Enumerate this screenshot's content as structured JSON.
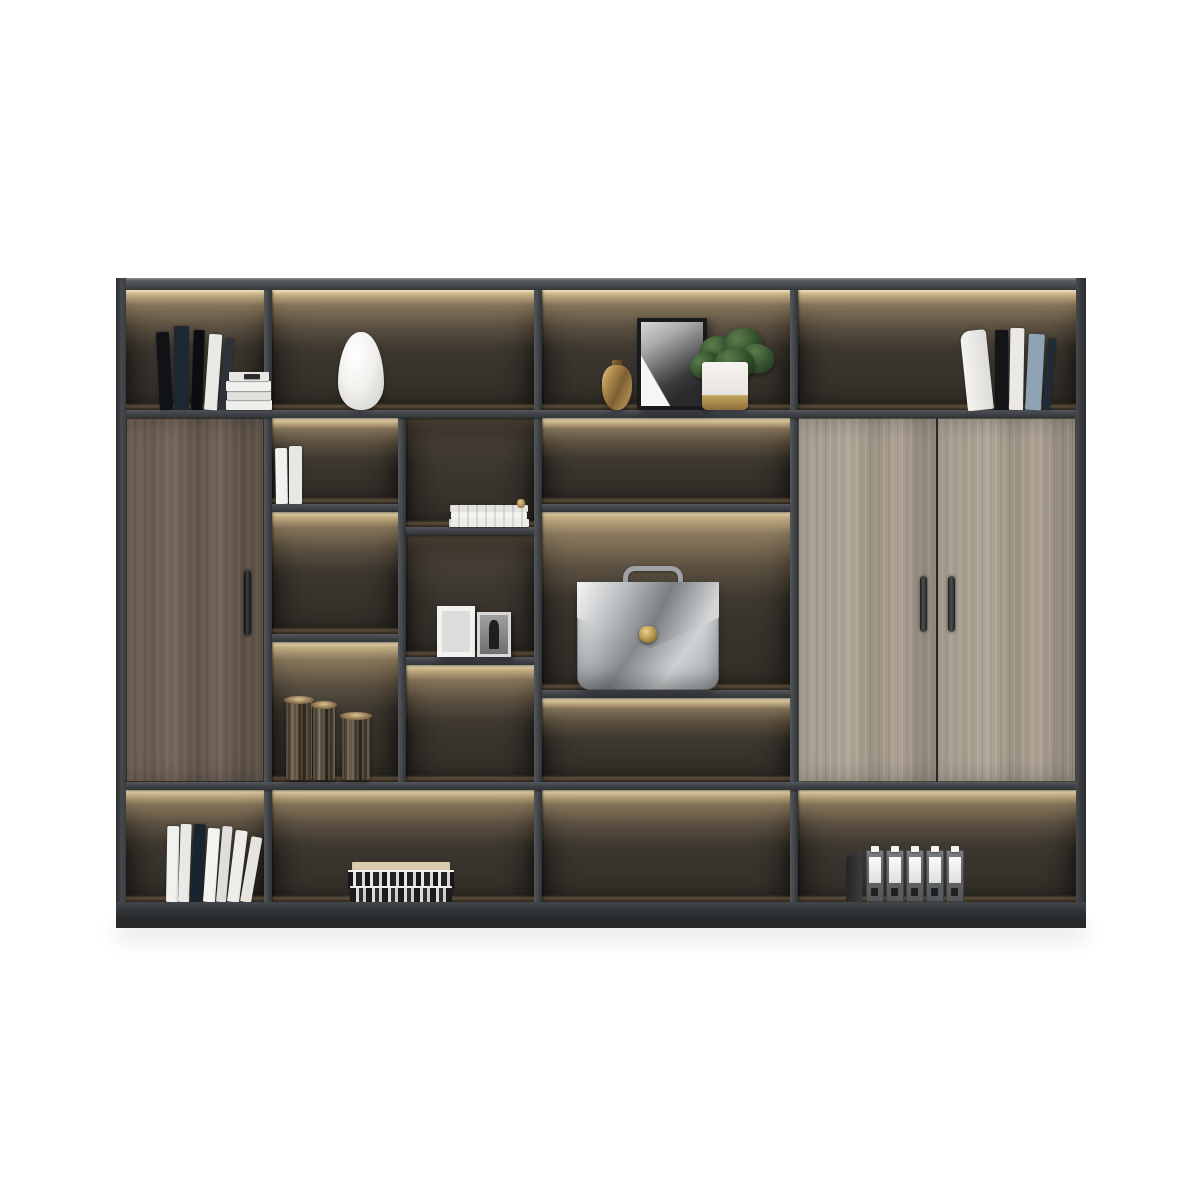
{
  "scene": {
    "title": "Modern office bookcase product photo",
    "description": "Charcoal grey executive bookcase with warm LED-lit compartments, a walnut single door, double light-oak doors, styled with books, a white vase, framed art, a plant, a silver briefcase and office binders on a white studio background",
    "background_color": "#ffffff"
  },
  "colors": {
    "bg": "#ffffff",
    "frame": "#42454a",
    "frame_dark": "#2c2e31",
    "frame_light": "#8c8f92",
    "cell_top": "#474139",
    "cell_bottom": "#322e28",
    "glow": "#f5e3ba",
    "glow_warm": "#d2b685",
    "floor_light": "#a38761",
    "wood_dark_a": "#79695c",
    "wood_dark_b": "#5d5147",
    "wood_light_a": "#b4aa9d",
    "wood_light_b": "#968c7e",
    "base_dark": "#26282a",
    "gold": "#c2a35b",
    "silver": "#c9ccce",
    "plant_green": "#33502b",
    "book_navy": "#1e2734",
    "book_steel_blue": "#8fa3b4"
  },
  "items": {
    "cabinet": "Executive display bookcase",
    "compartment": "LED-lit open compartment",
    "shelf": "Shelf panel",
    "divider": "Vertical divider panel",
    "left_door": "Walnut wood cabinet door",
    "right_doors": "Double light-oak cabinet doors",
    "door_handle": "Metal door handle",
    "books_top_left": "Leaning hardcover books with stacked books",
    "white_vase": "White ceramic teardrop vase",
    "bronze_jar": "Small bronze vessel",
    "art_frame": "Black-framed monochrome artwork",
    "potted_plant": "Green plant in white and brass pot",
    "books_top_right": "Leaning hardcover books",
    "white_paperbacks": "Two white paperback books",
    "magazine_stack": "Small stack of magazines",
    "photo_frames": "Two standing photo frames",
    "candle_holders": "Bronze fluted candle holders",
    "briefcase": "Silver leather briefcase with brass clasp",
    "books_bottom_left": "Leaning white and navy books",
    "book_stack": "Stacked books with patterned jackets",
    "binders": "Row of five grey ring binders",
    "bookend": "Metal bookend",
    "base": "Cabinet plinth base"
  }
}
